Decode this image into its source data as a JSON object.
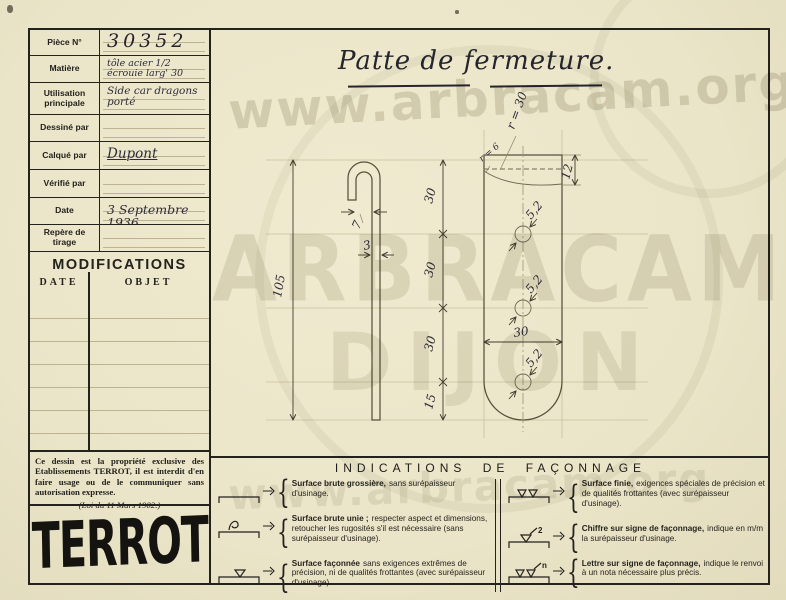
{
  "colors": {
    "paper": "#eae4c8",
    "ink": "#23221d",
    "pencil": "#57503d",
    "faint_line": "#bdb391",
    "watermark": "#6a6140"
  },
  "form": {
    "rows": [
      {
        "label": "Pièce N°",
        "value": "30352"
      },
      {
        "label": "Matière",
        "value": "tôle acier 1/2 écrouie larg' 30"
      },
      {
        "label": "Utilisation principale",
        "value": "Side car dragons porté"
      },
      {
        "label": "Dessiné par",
        "value": ""
      },
      {
        "label": "Calqué par",
        "value": "Dupont"
      },
      {
        "label": "Vérifié par",
        "value": ""
      },
      {
        "label": "Date",
        "value": "3 Septembre 1936"
      },
      {
        "label": "Repère de tirage",
        "value": ""
      }
    ]
  },
  "modifications": {
    "title": "MODIFICATIONS",
    "columns": [
      "DATE",
      "OBJET"
    ]
  },
  "notice": {
    "body": "Ce dessin est la propriété exclusive des Etablissements TERROT, il est interdit d'en faire usage ou de le communiquer sans autorisation expresse.",
    "law": "(Loi du 11 Mars 1902.)"
  },
  "logo": {
    "text": "TERROT"
  },
  "drawing": {
    "title": "Patte de fermeture.",
    "dims": {
      "length": "105",
      "hook_gap": "7",
      "thickness": "3",
      "seg1": "30",
      "seg2": "30",
      "seg3": "30",
      "seg4": "15",
      "width": "30",
      "offset": "12",
      "radius_top": "r = 30",
      "radius_corner": "r = 6",
      "hole1": "5,2",
      "hole2": "5,2",
      "hole3": "5,2"
    }
  },
  "indications": {
    "title": "INDICATIONS DE FAÇONNAGE",
    "brace": "{",
    "symbol_marks": {
      "chiffre": "2",
      "lettre": "n"
    },
    "left": [
      {
        "lead": "Surface brute grossière,",
        "rest": "sans surépaisseur d'usinage."
      },
      {
        "lead": "Surface brute unie ;",
        "rest": "respecter aspect et dimensions, retoucher les rugosités s'il est nécessaire (sans surépaisseur d'usinage)."
      },
      {
        "lead": "Surface façonnée",
        "rest": "sans exigences extrêmes de précision, ni de qualités frottantes (avec surépaisseur d'usinage)."
      }
    ],
    "right": [
      {
        "lead": "Surface finie,",
        "rest": "exigences spéciales de précision et de qualités frottantes (avec surépaisseur d'usinage)."
      },
      {
        "lead": "Chiffre sur signe de façonnage,",
        "rest": "indique en m/m la surépaisseur d'usinage."
      },
      {
        "lead": "Lettre sur signe de façonnage,",
        "rest": "indique le renvoi à un nota nécessaire plus précis."
      }
    ]
  },
  "watermark": {
    "url_text": "www.arbracam.org",
    "name": "ARBRACAM",
    "city": "DIJON"
  }
}
